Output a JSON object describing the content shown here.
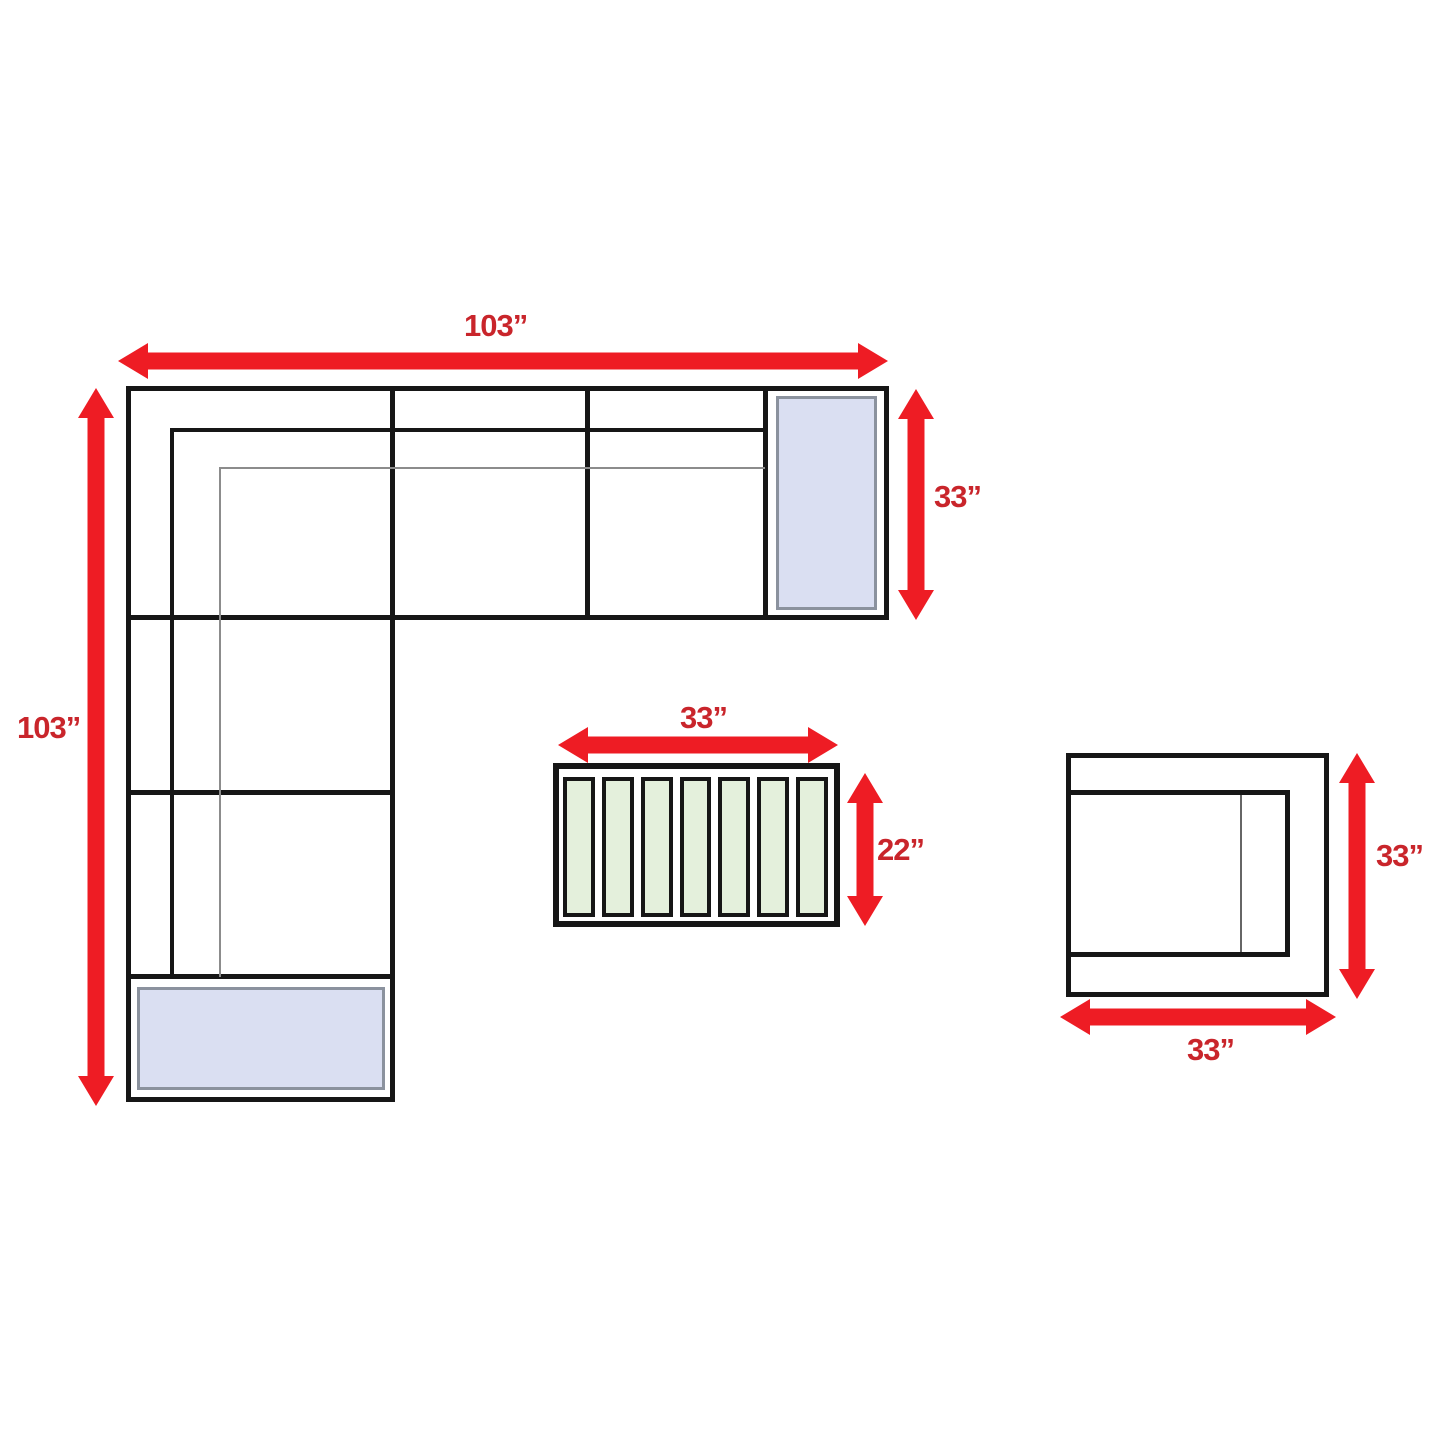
{
  "colors": {
    "arrow_red": "#ee1c24",
    "label_red": "#c9252b",
    "line_black": "#161616",
    "line_gray": "#8c8c8c",
    "cushion_blue": "#dadff2",
    "cushion_border_gray": "#8b929e",
    "slat_green": "#e4f0dc",
    "background": "#ffffff"
  },
  "sofa": {
    "width_label": "103”",
    "height_label": "103”",
    "depth_label": "33”"
  },
  "coffee_table": {
    "width_label": "33”",
    "depth_label": "22”",
    "slat_count": 7
  },
  "chair": {
    "width_label": "33”",
    "depth_label": "33”"
  }
}
